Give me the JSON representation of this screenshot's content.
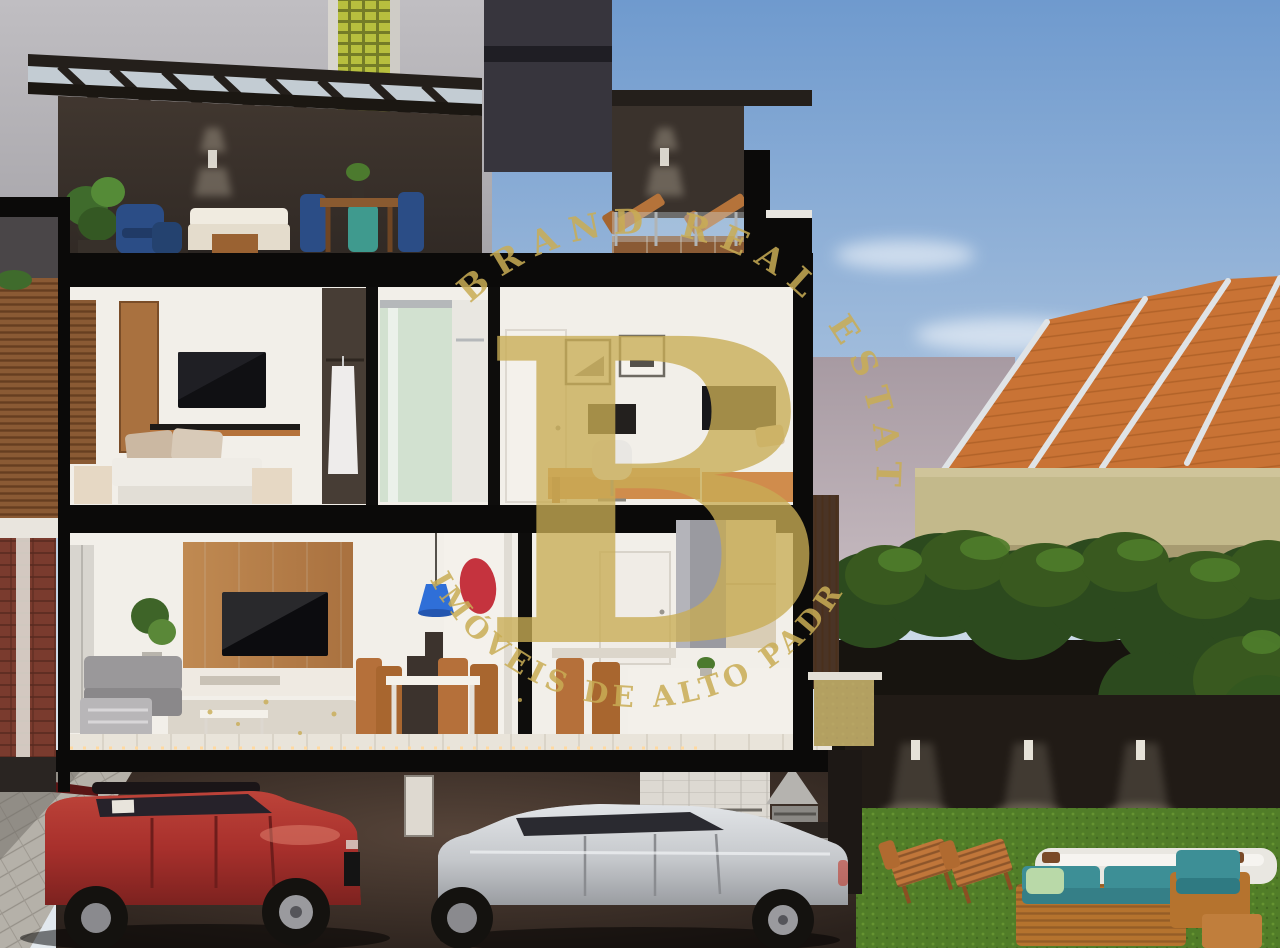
{
  "scene": {
    "description": "Daylight 3D architectural cutaway cross-section of a three-storey townhouse: roof terrace with pergola, bedroom/bathroom/home-office floor, living-dining-kitchen floor, garage with red and silver SUVs, and a backyard lawn with garden furniture beside a neighboring orange tiled-roof house."
  },
  "watermark": {
    "arc_top": "BRAND REAL ESTATE",
    "arc_bottom": "IMÓVEIS DE ALTO PADRÃO",
    "monogram": "B",
    "color": "#C9AD55"
  },
  "palette": {
    "sky_blue": "#6F9ACE",
    "building_gray": "#B4B2B6",
    "glass_block_green": "#B7BF3E",
    "roof_orange": "#C97335",
    "roof_ridge_white": "#DFE3E6",
    "wall_mauve": "#A89AA2",
    "wall_yellow": "#C3B98B",
    "hedge_green": "#33571F",
    "grass_green": "#517D28",
    "frame_black": "#0B0A09",
    "terrace_wall_brown": "#3A322C",
    "interior_white": "#F2EFE9",
    "wood_brown": "#B5723A",
    "cushion_teal": "#3D8F96",
    "car_red": "#A8302C",
    "car_silver": "#C9CBCE"
  }
}
